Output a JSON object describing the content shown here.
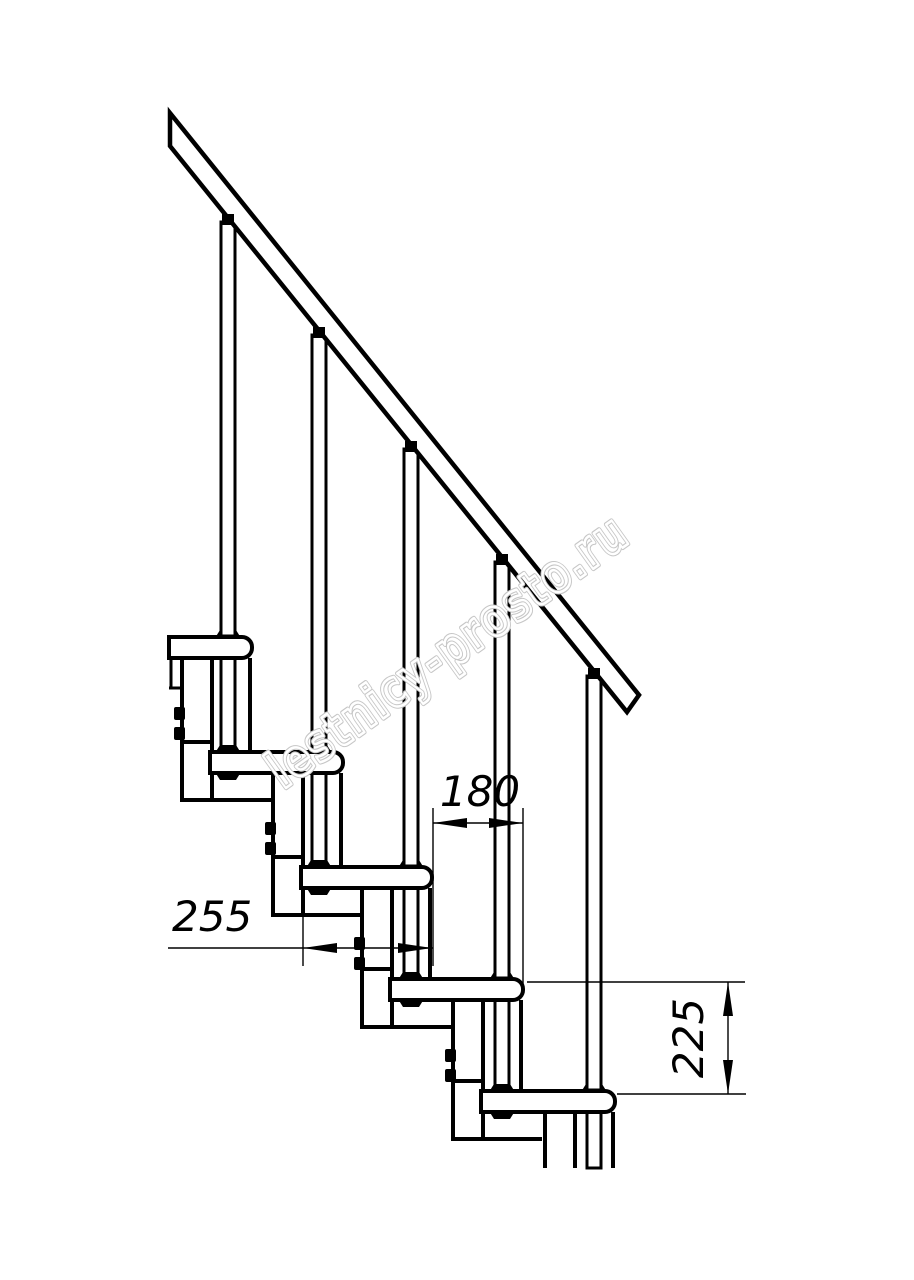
{
  "drawing": {
    "type": "staircase-side-elevation",
    "colors": {
      "background": "#ffffff",
      "line": "#000000",
      "watermark_outline": "#c6c6c6"
    },
    "dimensions": {
      "step_run": "180",
      "tread_depth": "255",
      "step_rise": "225"
    },
    "watermark": {
      "text": "lestnicy-prosto.ru",
      "color": "#c6c6c6"
    }
  }
}
